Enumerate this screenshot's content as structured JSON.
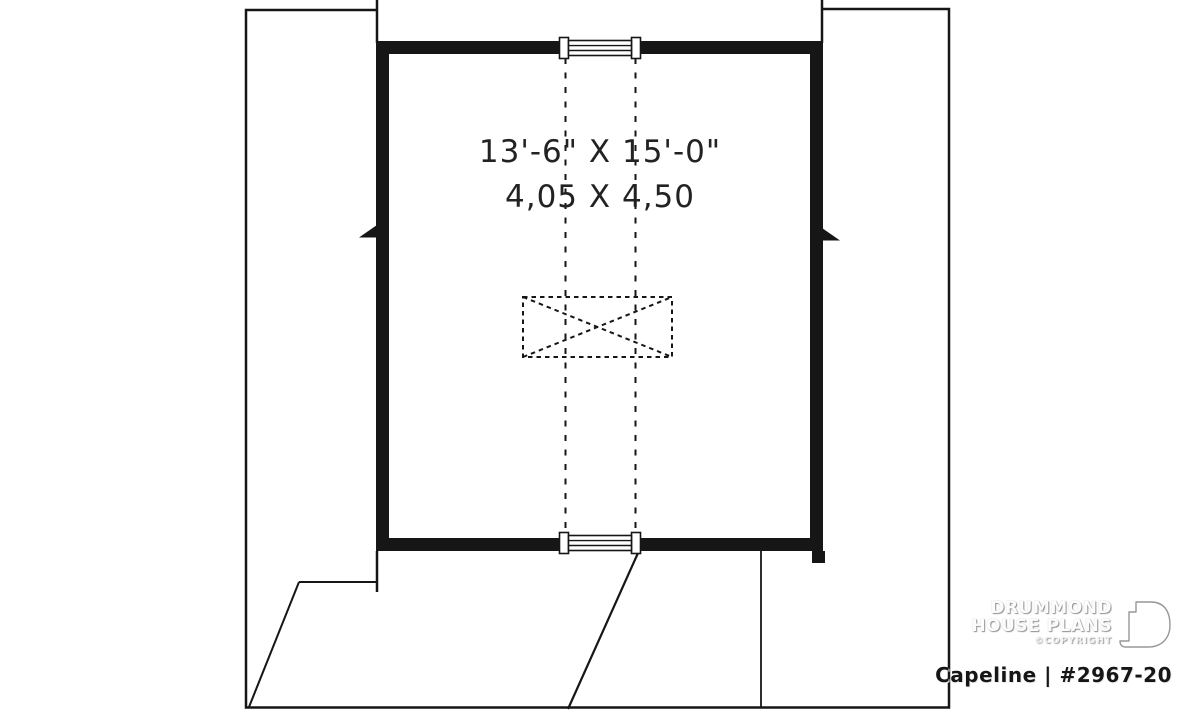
{
  "canvas": {
    "background": "#ffffff",
    "ink": "#161616"
  },
  "floorplan": {
    "dimension_imperial": "13'-6\" X 15'-0\"",
    "dimension_metric": "4,05 X 4,50"
  },
  "branding": {
    "name_line1": "DRUMMOND",
    "name_line2": "HOUSE PLANS",
    "copyright": "©COPYRIGHT",
    "plan_name": "Capeline",
    "separator": "|",
    "plan_number": "#2967-20"
  }
}
